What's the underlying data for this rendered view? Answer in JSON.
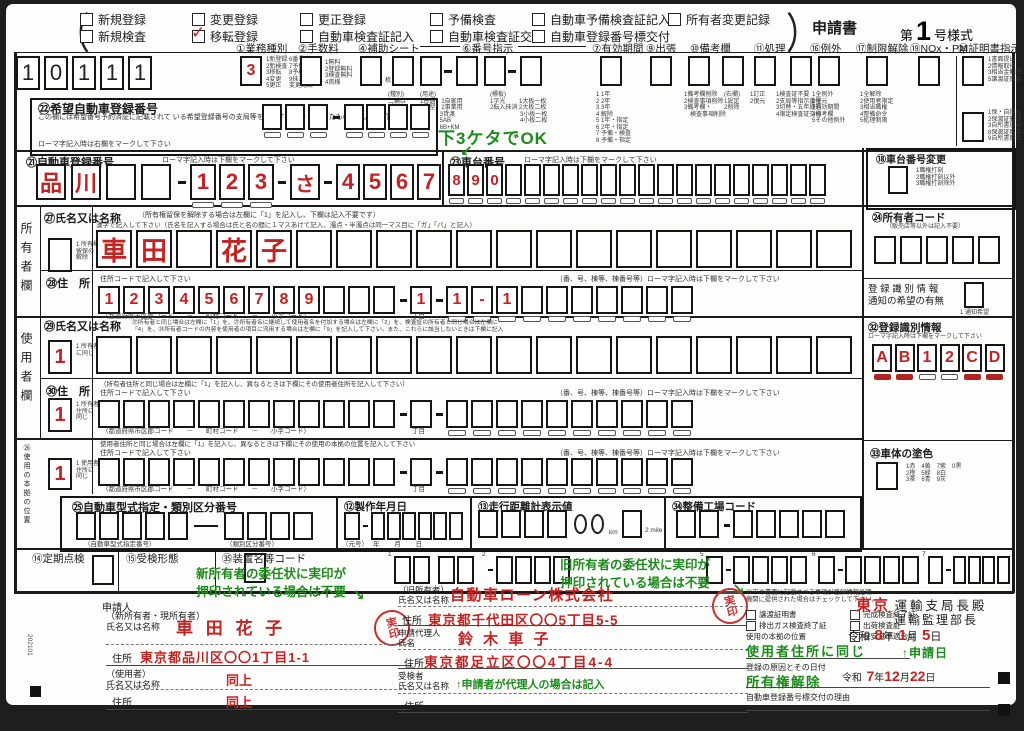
{
  "form_head": {
    "paren_open": "（",
    "paren_close": "）",
    "title": "申請書",
    "series_prefix": "第",
    "series_no": "1",
    "series_suffix": "号様式",
    "row1": [
      {
        "label": "新規登録",
        "checked": false
      },
      {
        "label": "変更登録",
        "checked": false
      },
      {
        "label": "更正登録",
        "checked": false
      },
      {
        "label": "予備検査",
        "checked": false
      },
      {
        "label": "自動車予備検査証記入",
        "checked": false
      },
      {
        "label": "所有者変更記録",
        "checked": false
      }
    ],
    "row2": [
      {
        "label": "新規検査",
        "checked": false
      },
      {
        "label": "移転登録",
        "checked": true
      },
      {
        "label": "自動車検査証記入",
        "checked": false
      },
      {
        "label": "自動車検査証交付",
        "checked": false
      },
      {
        "label": "自動車登録番号標交付",
        "checked": false
      }
    ]
  },
  "office_code": {
    "cells": [
      "1",
      "0",
      "1",
      "1",
      "1"
    ]
  },
  "top_fields": {
    "gyomu": {
      "label": "①業務種別",
      "cells": [
        "3"
      ],
      "note": "1新登録 6番号変更\n2新検査 7予備検査\n3移転　 8予検記入\n4変更　 9抹消\n5更正　 変更記録"
    },
    "tesuryo": {
      "label": "②手数料",
      "cells": [
        ""
      ],
      "note": "1無料\n2登録無料\n3検査無料\n4両様"
    },
    "hojo": {
      "label": "④補助シート",
      "cells": [
        ""
      ],
      "unit": "枚"
    },
    "bango": {
      "label": "⑥番号指示",
      "cells_a": [
        "",
        ""
      ],
      "cells_b": [
        "",
        ""
      ],
      "cells_c": [
        ""
      ],
      "note_a": "(種別)\n二輪は\n「－」",
      "note_b": "(用途)\n1普通　1自家用\n2小型　2事業用\n　　　 3貸渡\n　　　 5AB\n　　　 6B+KM",
      "note_c": "(標板)\n1字光　　 1大板一枚\n2転入抹消 2大板二枚\n　　　　　3小板一枚\n　　　　　4小板二枚"
    },
    "yuko": {
      "label": "⑦有効期間",
      "cells": [
        ""
      ],
      "note": "1 1年\n2 2年\n3 3年\n4 解除\n5 1年・指定\n6 2年・指定\n7 予備・検査\n8 予備・指定"
    },
    "shucchou": {
      "label": "⑨出張",
      "cells": [
        ""
      ]
    },
    "biko": {
      "label": "⑩備考欄",
      "cells_a": [
        ""
      ],
      "cells_b": [
        ""
      ],
      "note_a": "1備考欄削除\n2検査事項削除\n3備考欄・\n　検査事項削除",
      "note_b": "(右欄)\n1設定\n2削除"
    },
    "shori": {
      "label": "⑪処理",
      "cells_a": [
        ""
      ],
      "cells_b": [
        ""
      ],
      "note_a": "1訂正\n2復元",
      "note_b": "1検査証不要\n2支局等指示番号\n3切替・五年経過\n4限定検査証交付"
    },
    "reigai": {
      "label": "⑯例外",
      "cells": [
        ""
      ],
      "note": "1全例外\n2復元\n3有効期間\n4備考欄\n5その他例外"
    },
    "seigen": {
      "label": "⑰制限解除",
      "cells": [
        ""
      ],
      "note": "1全解除\n2使用者限定\n3相当職権\n4整備命令\n5処理制限"
    },
    "nox": {
      "label": "⑲NOx・PM",
      "cells": [
        ""
      ]
    },
    "shomei": {
      "label": "⑳証明書指示",
      "cells_a": [
        ""
      ],
      "cells_b": [
        ""
      ],
      "note_a": "1書面提出\n2情報取得\n3相当金解除\n5譲渡証照会",
      "note_b": "1保・自提出\n2保渡証取得\n3自所書提出\n8保渡証照会\n9自所書照会"
    }
  },
  "kibo": {
    "title": "㉒希望自動車登録番号",
    "desc": "この欄には希望番号予約済証に記載されて\nいる希望登録番号の支局等を表示する文字\nを除いたものを記入して下さい",
    "note": "ローマ字記入時は右欄をマークして下さい",
    "cells_a": [
      "",
      "",
      ""
    ],
    "cells_b": [
      "",
      "",
      "",
      ""
    ]
  },
  "touroku": {
    "title": "㉑自動車登録番号",
    "note": "ローマ字記入時は下欄をマークして下さい",
    "cells_a": [
      "品",
      "川",
      "",
      ""
    ],
    "cells_b": [
      "1",
      "2",
      "3"
    ],
    "cells_c": [
      "さ"
    ],
    "cells_d": [
      "4",
      "5",
      "6",
      "7"
    ]
  },
  "shadai": {
    "title": "㉓車台番号",
    "note": "ローマ字記入時は下欄をマークして下さい",
    "cells": [
      "8",
      "9",
      "0",
      "",
      "",
      "",
      "",
      "",
      "",
      "",
      "",
      "",
      "",
      "",
      "",
      "",
      "",
      "",
      "",
      ""
    ]
  },
  "shadai_henko": {
    "title": "⑱車台番号変更",
    "cells": [
      ""
    ],
    "note": "1職権打刻\n2職権打刻以外\n3職権打刻除外"
  },
  "owner": {
    "side_label": "所有者欄",
    "name_title": "㉗氏名又は名称",
    "name_note": "（所有権留保を解除する場合は左欄に「1」を記入し、下欄は記入不要です）",
    "kanji_note": "漢字で記入して下さい（氏名を記入する場合は氏と名の間に１マスあけて記入、濁点・半濁点は同一マス目に「ガ」「パ」と記入）",
    "flag_label": "1 所有権\n留保の\n解除",
    "flag": [
      ""
    ],
    "name_cells": [
      "車",
      "田",
      "",
      "花",
      "子",
      "",
      "",
      "",
      "",
      "",
      "",
      "",
      "",
      "",
      "",
      "",
      "",
      "",
      ""
    ],
    "addr_title": "㉘住　所",
    "addr_note": "住所コードで記入して下さい",
    "addr_note2": "（番、号、棟等、棟番号等）ローマ字記入時は下欄をマークして下さい",
    "addr_cells_a": [
      "1",
      "2",
      "3",
      "4",
      "5",
      "6",
      "7",
      "8",
      "9",
      "",
      "",
      ""
    ],
    "addr_cells_b": [
      "1"
    ],
    "addr_cells_c": [
      "1",
      "-",
      "1",
      "",
      "",
      "",
      "",
      "",
      "",
      ""
    ],
    "addr_labels": "（都道府県市区郡コード　　－　　町村コード　　－　　小字コード）",
    "chome_label": "丁目"
  },
  "user": {
    "side_label": "使用者欄",
    "name_title": "㉙氏名又は名称",
    "name_note": "㉗所有者と同じ場合は左欄に「1」を、㉗所有者名に継続して使用者名を付加する場合は左欄に「2」を、検査証の所有者と同じ場合は左欄に\n「4」を、㉔所有者コードの内容を使用者の項目に流用する場合は左欄に「9」を記入して下さい。また、これらに該当しないときは下欄に記入",
    "flag_label": "1 所有者\nに同じ",
    "flag": [
      "1"
    ],
    "name_cells": [
      "",
      "",
      "",
      "",
      "",
      "",
      "",
      "",
      "",
      "",
      "",
      "",
      "",
      "",
      "",
      "",
      "",
      "",
      ""
    ],
    "addr_title": "㉚住　所",
    "addr_note": "（所有者住所と同じ場合は左欄に「1」を記入し、異なるときは下欄にその使用者住所を記入して下さい）",
    "code_note": "住所コードで記入して下さい",
    "addr_note2": "（番、号、棟等、棟番号等）ローマ字記入時は下欄をマークして下さい",
    "flag2_label": "1 所有者\n住所に\n同じ",
    "flag2": [
      "1"
    ],
    "addr_cells_a": [
      "",
      "",
      "",
      "",
      "",
      "",
      "",
      "",
      "",
      "",
      "",
      ""
    ],
    "addr_cells_b": [
      ""
    ],
    "addr_cells_c": [
      "",
      "",
      "",
      "",
      "",
      "",
      "",
      "",
      "",
      ""
    ],
    "addr_labels": "（都道府県市区郡コード　　－　　町村コード　　－　　小字コード）",
    "chome_label": "丁目"
  },
  "honkyo": {
    "side_label": "㉖使用の本拠の位置",
    "note": "使用者住所と同じ場合は左欄に「1」を記入し、異なるときは下欄にその使用の本拠の位置を記入して下さい",
    "code_note": "住所コードで記入して下さい",
    "addr_note2": "（番、号、棟等、棟番号等）ローマ字記入時は下欄をマークして下さい",
    "flag_label": "1 使用者\n住所に\n同じ",
    "flag": [
      "1"
    ],
    "addr_cells_a": [
      "",
      "",
      "",
      "",
      "",
      "",
      "",
      "",
      "",
      "",
      "",
      ""
    ],
    "addr_cells_b": [
      ""
    ],
    "addr_cells_c": [
      "",
      "",
      "",
      "",
      "",
      "",
      "",
      "",
      "",
      ""
    ],
    "addr_labels": "（都道府県市区郡コード　　－　　町村コード　　－　　小字コード）",
    "chome_label": "丁目"
  },
  "right_col": {
    "owner_code_title": "㉔所有者コード",
    "owner_code_note": "（販売店等以外は記入不要）",
    "owner_code_cells": [
      "",
      "",
      "",
      "",
      ""
    ],
    "tsuchi_label": "登 録 識 別 情 報\n通知の希望の有無",
    "tsuchi_cells": [
      ""
    ],
    "tsuchi_note": "1 通知希望",
    "shikibetsu_title": "㉜登録識別情報",
    "shikibetsu_note": "ローマ字記入時は下欄をマークして下さい",
    "shikibetsu_cells": [
      {
        "c": "A",
        "m": 1
      },
      {
        "c": "B",
        "m": 1
      },
      {
        "c": "1",
        "m": 0
      },
      {
        "c": "2",
        "m": 0
      },
      {
        "c": "C",
        "m": 1
      },
      {
        "c": "D",
        "m": 1
      }
    ],
    "color_title": "㉝車体の塗色",
    "color_cells": [
      ""
    ],
    "color_note": "1赤　4黄　7紫　0黒\n2橙　5緑　8白\n3茶　6青　9灰"
  },
  "mid_row": {
    "katashiki_title": "㉕自動車型式指定・類別区分番号",
    "katashiki_cells_a": [
      "",
      "",
      "",
      "",
      ""
    ],
    "katashiki_cells_b": [
      "",
      "",
      "",
      ""
    ],
    "katashiki_label_a": "（自動車型式指定番号）",
    "katashiki_label_b": "（類別区分番号）",
    "seisaku_title": "⑫製作年月日",
    "seisaku_cells_a": [
      ""
    ],
    "seisaku_cells_b": [
      "",
      "",
      "",
      "",
      "",
      ""
    ],
    "seisaku_labels": "（元号）　 年　　 月　　 日",
    "soko_title": "⑬走行距離計表示値",
    "soko_cells": [
      "",
      "",
      "",
      ""
    ],
    "soko_unit": "km",
    "soko_cells2": [
      ""
    ],
    "soko_unit2": "2 mile",
    "seibi_title": "㉞整備工場コード",
    "seibi_cells_a": [
      "",
      ""
    ],
    "seibi_cells_b": [
      "",
      "",
      "",
      "",
      ""
    ]
  },
  "bottom_row": {
    "teiki_title": "⑭定期点検",
    "teiki_cells": [
      ""
    ],
    "juken_title": "⑮受検形態",
    "juken_cells": [
      ""
    ],
    "sochi_title": "㉟装置名等コード",
    "groups": [
      {
        "sup": "1",
        "a": [
          "",
          ""
        ],
        "b": [
          "",
          ""
        ]
      },
      {
        "sup": "2",
        "b": [
          "",
          "",
          "",
          ""
        ]
      },
      {
        "sup": "5",
        "a": [
          ""
        ],
        "b": [
          "",
          "",
          "",
          ""
        ]
      },
      {
        "sup": "6",
        "a": [
          ""
        ],
        "b": [
          "",
          "",
          "",
          ""
        ]
      },
      {
        "sup": "7",
        "a": [
          ""
        ],
        "b": [
          "",
          "",
          "",
          ""
        ]
      }
    ]
  },
  "annotations": {
    "shadai_hint": "下3ケタでOK",
    "shadai_arrow": "↙",
    "new_owner_stamp_note": "新所有者の委任状に実印が\n押印されている場合は不要",
    "old_owner_stamp_note": "旧所有者の委任状に実印が\n押印されている場合は不要",
    "stamp_arrow": "↘",
    "proxy_note": "↑申請者が代理人の場合は記入",
    "apply_date_note": "↑申請日",
    "stamp_label": "実印"
  },
  "applicant": {
    "head": "申請人",
    "new_owner_label": "（新所有者・現所有者）\n氏名又は名称",
    "new_owner_name": "車 田 花 子",
    "addr_label": "住所",
    "new_owner_addr": "東京都品川区〇〇1丁目1-1",
    "user_label": "（使用者）\n氏名又は名称",
    "user_name": "同上",
    "user_addr": "同上",
    "doc_code": "202101"
  },
  "old_owner": {
    "label": "（旧所有者）\n氏名又は名称",
    "name": "自動車ローン株式会社",
    "addr_label": "住所",
    "addr": "東京都千代田区〇〇5丁目5-5",
    "proxy_label": "申請代理人\n氏名",
    "proxy_name": "鈴 木 車 子",
    "proxy_addr_label": "住所",
    "proxy_addr": "東京都足立区〇〇4丁目4-4",
    "jukensha_label": "受検者\n氏名又は名称",
    "jukensha_addr_label": "住所"
  },
  "submission": {
    "check_note": "以下の書面に記載すべき事項が登録情報処理\n機関に提供された場合はチェックして下さい。",
    "checks": [
      {
        "label": "譲渡証明書",
        "checked": false
      },
      {
        "label": "完成検査終了証",
        "checked": false
      },
      {
        "label": "排出ガス検査終了証",
        "checked": false
      },
      {
        "label": "出荷検査証",
        "checked": false
      },
      {
        "label": "保安基準適合証",
        "checked": false
      }
    ],
    "honkyo_label": "使用の本拠の位置",
    "honkyo_value": "使用者住所に同じ",
    "reason_label": "登録の原因とその日付",
    "reason_value": "所有権解除",
    "reason_era": "令和",
    "reason_y": "7",
    "reason_y_u": "年",
    "reason_m": "12",
    "reason_m_u": "月",
    "reason_d": "22",
    "reason_d_u": "日",
    "plate_reason_label": "自動車登録番号標交付の理由",
    "office_pref": "東京",
    "office_label": "運輸支局長殿",
    "office_label2": "運輸監理部長",
    "date_era": "令和",
    "date_y": "8",
    "date_y_u": "年",
    "date_m": "1",
    "date_m_u": "月",
    "date_d": "5",
    "date_d_u": "日"
  }
}
